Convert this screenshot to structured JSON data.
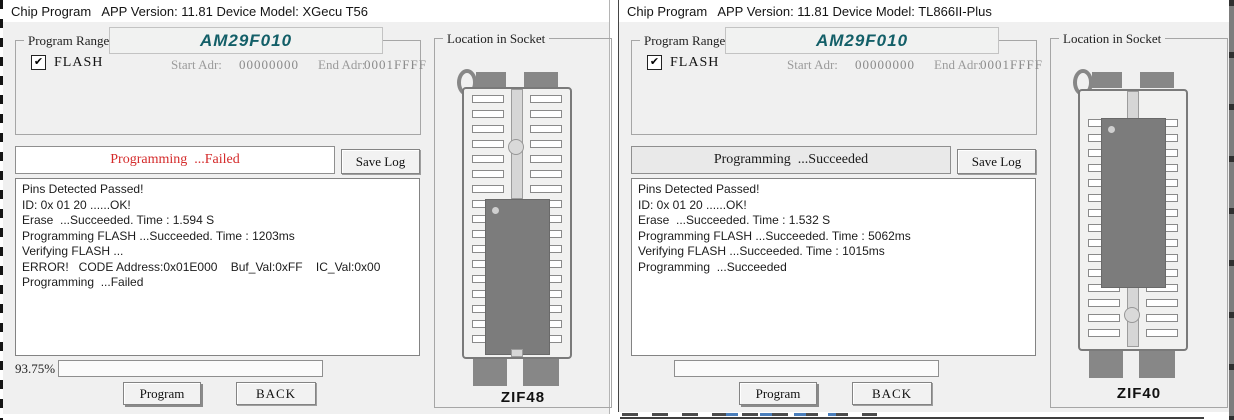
{
  "left_window": {
    "title": "Chip Program   APP Version: 11.81 Device Model: XGecu T56",
    "program_range": {
      "label": "Program Range",
      "chip_name": "AM29F010",
      "chip_name_color": "#135f68",
      "flash_label": "FLASH",
      "flash_checked": true,
      "start_adr_label": "Start Adr:",
      "start_adr_value": "00000000",
      "end_adr_label": "End Adr:",
      "end_adr_value": "0001FFFF"
    },
    "status": {
      "text": "Programming  ...Failed",
      "color": "#d42a2a",
      "background": "#ffffff"
    },
    "save_log_button": "Save Log",
    "log_lines": [
      "Pins Detected Passed!",
      "ID: 0x 01 20 ......OK!",
      "Erase  ...Succeeded. Time : 1.594 S",
      "Programming FLASH ...Succeeded. Time : 1203ms",
      "Verifying FLASH ...",
      "ERROR!   CODE Address:0x01E000    Buf_Val:0xFF    IC_Val:0x00",
      "Programming  ...Failed"
    ],
    "progress_label": "93.75%",
    "program_button": "Program",
    "back_button": "BACK",
    "socket_panel": {
      "label": "Location in Socket",
      "socket_type": "ZIF48"
    }
  },
  "right_window": {
    "title": "Chip Program   APP Version: 11.81 Device Model: TL866II-Plus",
    "program_range": {
      "label": "Program Range",
      "chip_name": "AM29F010",
      "chip_name_color": "#135f68",
      "flash_label": "FLASH",
      "flash_checked": true,
      "start_adr_label": "Start Adr:",
      "start_adr_value": "00000000",
      "end_adr_label": "End Adr:",
      "end_adr_value": "0001FFFF"
    },
    "status": {
      "text": "Programming  ...Succeeded",
      "color": "#1a1a1a",
      "background": "#e9e9e9"
    },
    "save_log_button": "Save Log",
    "log_lines": [
      "Pins Detected Passed!",
      "ID: 0x 01 20 ......OK!",
      "Erase  ...Succeeded. Time : 1.532 S",
      "Programming FLASH ...Succeeded. Time : 5062ms",
      "Verifying FLASH ...Succeeded. Time : 1015ms",
      "Programming  ...Succeeded"
    ],
    "progress_label": "",
    "program_button": "Program",
    "back_button": "BACK",
    "socket_panel": {
      "label": "Location in Socket",
      "socket_type": "ZIF40"
    }
  }
}
